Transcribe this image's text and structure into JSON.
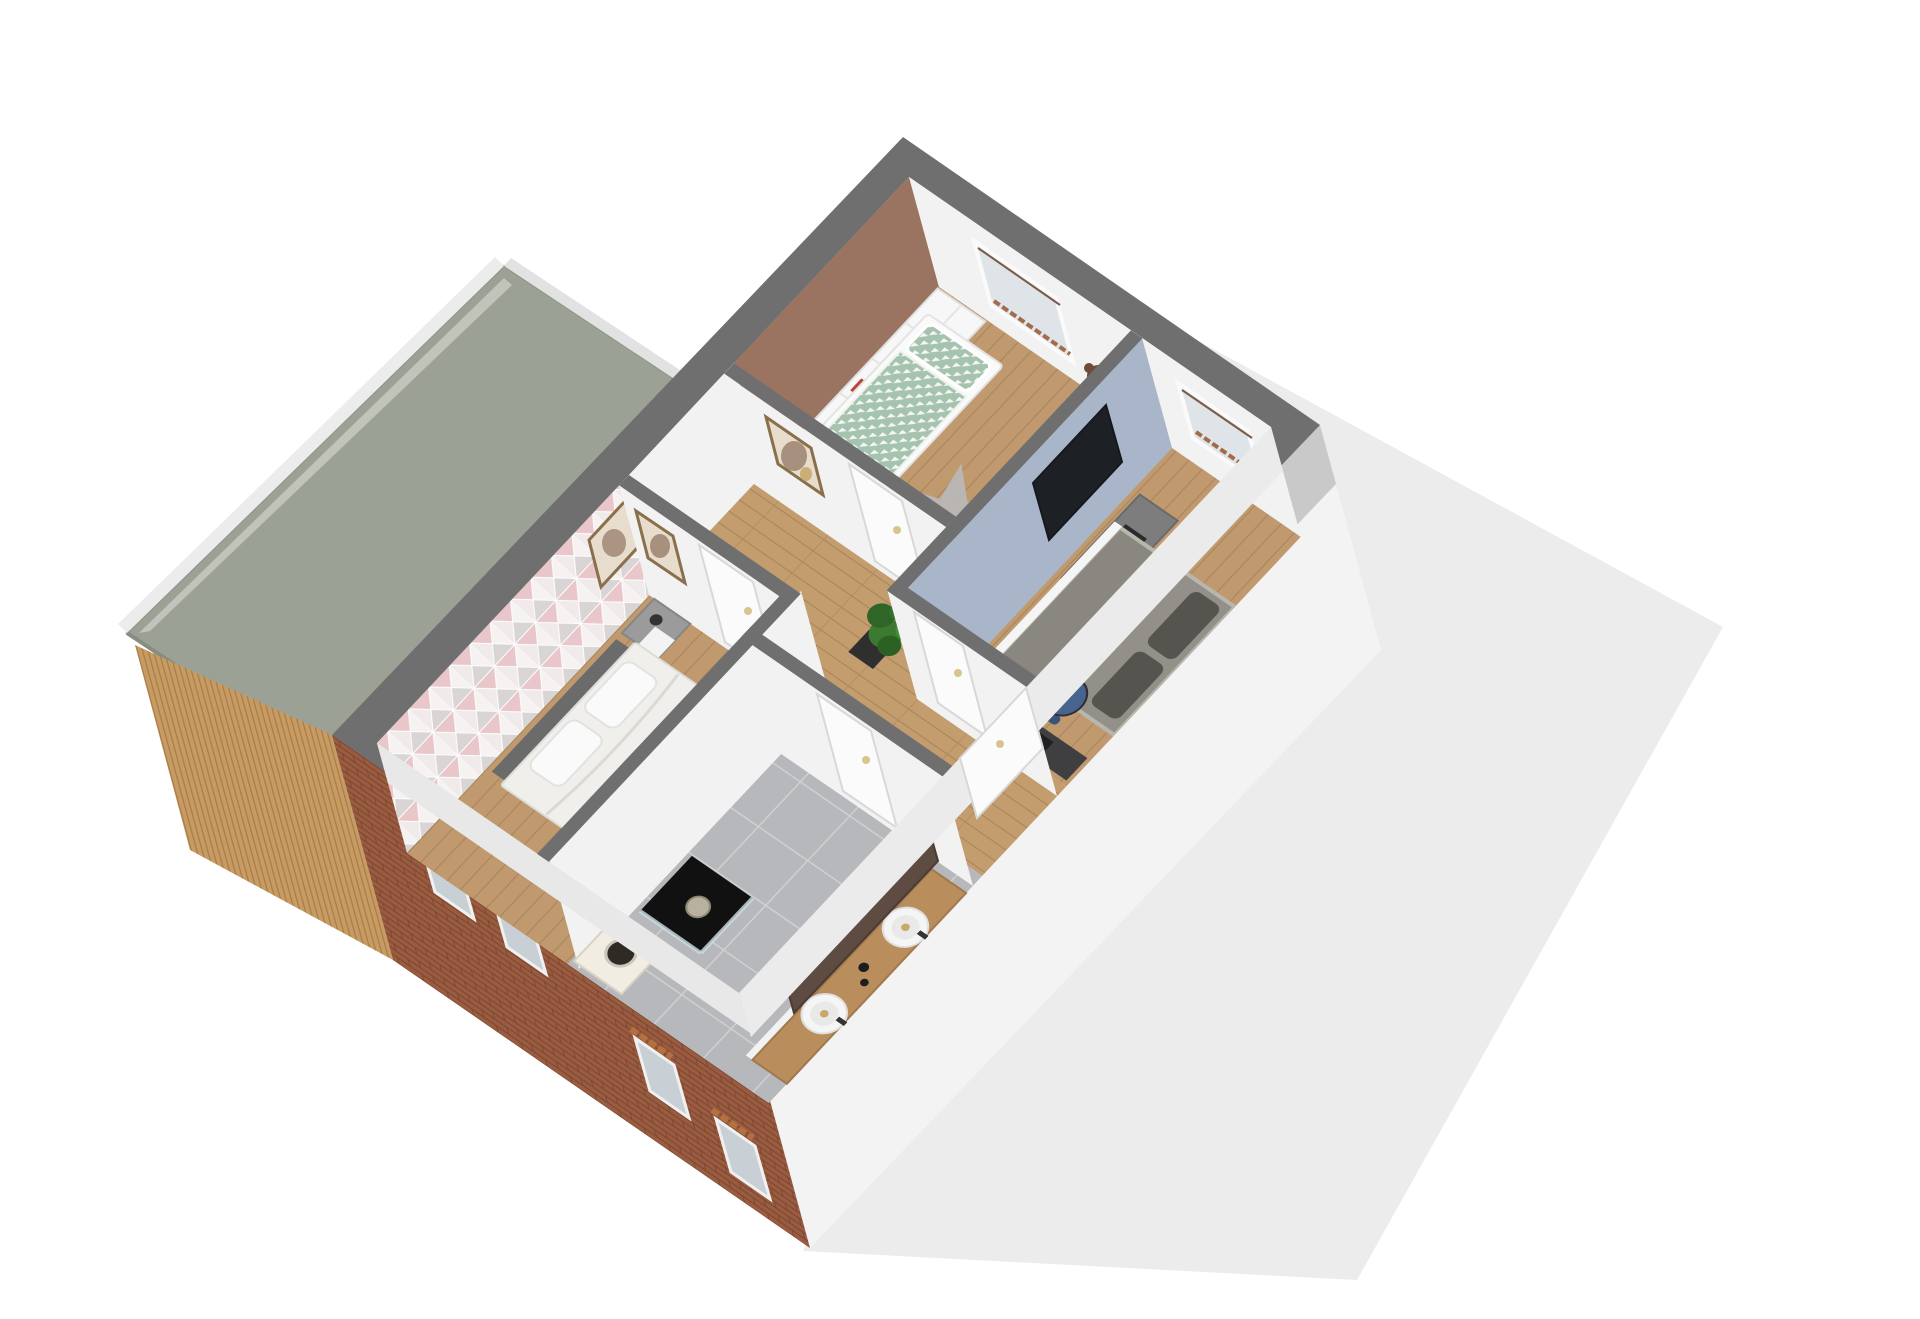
{
  "scene": {
    "kind": "3d-floorplan-dollhouse-render",
    "view": "isometric top-down view of an upper storey, rotated ~40 degrees",
    "visible_text": "none"
  },
  "colors": {
    "background": "#ffffff",
    "ground_shadow": "#ececec",
    "wall_cap": "#6f6f6f",
    "interior_wall": "#f2f2f2",
    "inner_base": "#e9e8e6",
    "roof": "#9ba194",
    "roof_fascia": "#ececec",
    "wood_facade": "#c79b63",
    "brick": "#9a5c40",
    "gable_wall": "#f3f3f3",
    "gable_shadow": "#c9c9c9",
    "wood_floor": "#c09a6e",
    "hallway_floor": "#c49d6f",
    "tile_floor": "#b6b8bb",
    "accent_brown": "#9b7361",
    "accent_blue": "#a9b6ca",
    "accent_pink_base": "#f0ebea",
    "duvet_green": "#a5c3af",
    "bed_white": "#f0efec",
    "headboard_gray": "#6b6b6b",
    "mattress_taupe": "#93908a",
    "pillow_dark": "#55544e",
    "rug_gray": "#b9b9b9",
    "tv_black": "#1d2126",
    "tv_cabinet_gray": "#7d7d7d",
    "desk_dark": "#3f3f41",
    "chair_blue": "#47648f",
    "chair_red": "#c0303e",
    "desk_white": "#f7f7f7",
    "vanity_wood": "#b98d5c",
    "sink_white": "#f5f5f5",
    "bath_mirror_brown": "#5e4c42",
    "shower_black": "#111111",
    "washer_cream": "#f1ede2",
    "plant_green": "#3c7a31",
    "plant_pot": "#2f2f2f",
    "door_white": "#fbfbfb",
    "window_glass": "#dfe4e8",
    "teddy_brown": "#6f4c38",
    "nightstand_gray": "#9b9b9b"
  },
  "rooms": [
    {
      "name": "children-bedroom",
      "floor": "wood",
      "accent_wall": "terracotta brown",
      "furniture": [
        "white shelf storage unit",
        "single bed with green-white patterned duvet",
        "white wardrobe",
        "gray star rug",
        "teddy bear",
        "window"
      ]
    },
    {
      "name": "bedroom-2",
      "floor": "wood",
      "accent_wall": "light blue with wall TV",
      "furniture": [
        "gray double bed with two dark pillows",
        "gray tv cabinet",
        "dark desk",
        "blue office chair",
        "window"
      ]
    },
    {
      "name": "hallway",
      "floor": "wood planks",
      "furniture": [
        "four white doors",
        "two picture frames",
        "potted plant"
      ]
    },
    {
      "name": "master-bedroom",
      "floor": "wood",
      "accent_wall": "pink-gray triangle wallpaper",
      "furniture": [
        "double bed with gray headboard and white duvet",
        "gray nightstand",
        "white desk",
        "red chair",
        "round mirror",
        "picture frame"
      ]
    },
    {
      "name": "bathroom",
      "floor": "gray tiles",
      "furniture": [
        "double sink wooden vanity",
        "large dark mirror",
        "black shower",
        "washing machine"
      ]
    }
  ],
  "exterior": {
    "elements": [
      "flat sage-green roof over side annex",
      "white fascia edge",
      "vertical wood slat facade",
      "red-brick facade with four small windows",
      "white gable wall",
      "light gray ground shadow plane"
    ]
  }
}
